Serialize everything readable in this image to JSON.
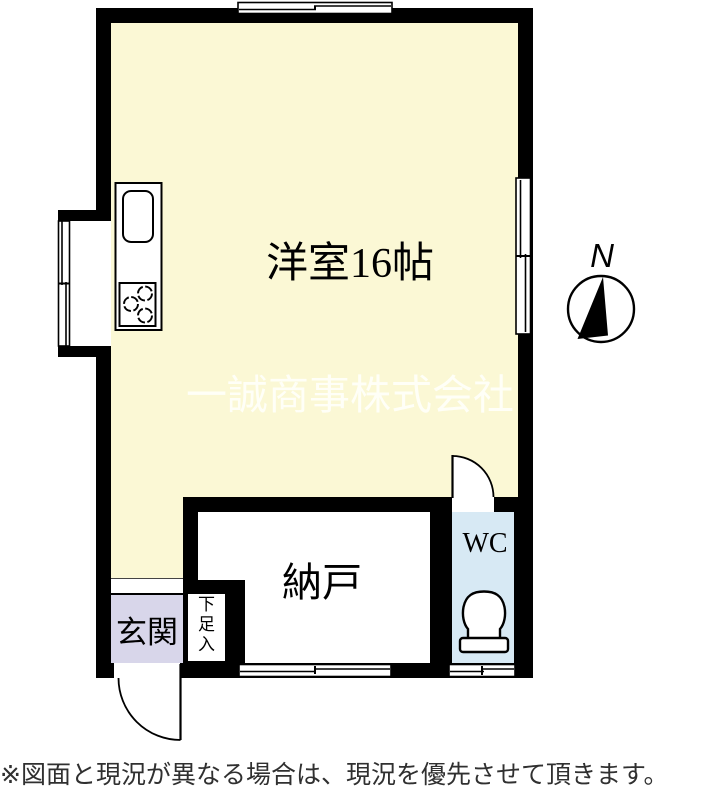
{
  "plan": {
    "rooms": {
      "main": {
        "label": "洋室16帖"
      },
      "storage": {
        "label": "納戸"
      },
      "wc": {
        "label": "WC"
      },
      "entrance": {
        "label": "玄関"
      },
      "shoebox": {
        "label": "下足入"
      }
    },
    "compass": {
      "label": "N"
    },
    "watermark": {
      "text": "一誠商事株式会社"
    },
    "note": {
      "text": "※図面と現況が異なる場合は、現況を優先させて頂きます。"
    },
    "colors": {
      "wall": "#000000",
      "main_room_fill": "#FBF8D5",
      "entrance_fill": "#D8D6EA",
      "wc_fill": "#D7E9F4",
      "watermark_text": "#FFFFFA",
      "note_text": "#303030"
    }
  }
}
